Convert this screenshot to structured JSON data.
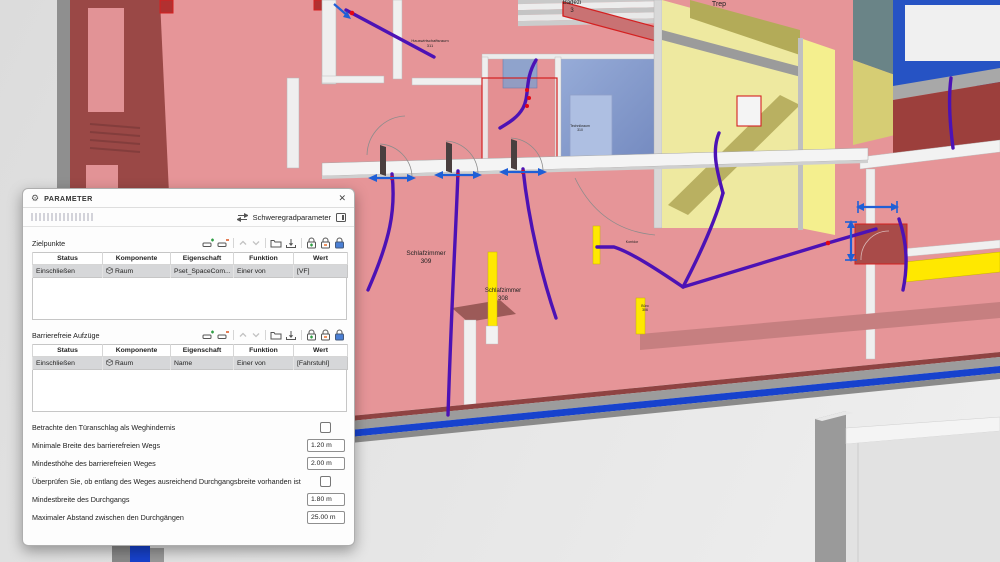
{
  "dialog": {
    "title": "PARAMETER",
    "mode_label": "Schweregradparameter",
    "close_glyph": "✕",
    "sections": [
      {
        "label": "Zielpunkte",
        "columns": [
          "Status",
          "Komponente",
          "Eigenschaft",
          "Funktion",
          "Wert"
        ],
        "rows": [
          {
            "status": "Einschließen",
            "komponente": "Raum",
            "eigenschaft": "Pset_SpaceCom...",
            "funktion": "Einer von",
            "wert": "[VF]"
          }
        ]
      },
      {
        "label": "Barrierefreie Aufzüge",
        "columns": [
          "Status",
          "Komponente",
          "Eigenschaft",
          "Funktion",
          "Wert"
        ],
        "rows": [
          {
            "status": "Einschließen",
            "komponente": "Raum",
            "eigenschaft": "Name",
            "funktion": "Einer von",
            "wert": "[Fahrstuhl]"
          }
        ]
      }
    ],
    "section_toolbar_icons": [
      "add-row",
      "remove-row",
      "move-up",
      "move-down",
      "open-folder",
      "import",
      "add-lock",
      "unlock",
      "lock"
    ],
    "options": [
      {
        "label": "Betrachte den Türanschlag als Weghindernis",
        "type": "checkbox",
        "checked": false
      },
      {
        "label": "Minimale Breite des barrierefreien Wegs",
        "type": "input",
        "value": "1.20 m"
      },
      {
        "label": "Mindesthöhe des barrierefreien Weges",
        "type": "input",
        "value": "2.00 m"
      },
      {
        "label": "Überprüfen Sie, ob entlang des Weges ausreichend Durchgangsbreite vorhanden ist",
        "type": "checkbox",
        "checked": false
      },
      {
        "label": "Mindestbreite des Durchgangs",
        "type": "input",
        "value": "1.80 m"
      },
      {
        "label": "Maximaler Abstand zwischen den Durchgängen",
        "type": "input",
        "value": "25.00 m"
      }
    ]
  },
  "scene": {
    "labels": {
      "hwr1": "Hauswirtschaftsraum",
      "hwr2": "311",
      "bad1": "Badezi",
      "bad2": "3",
      "trep": "Trep",
      "tech1": "Technikraum",
      "tech2": "310",
      "korridor": "Korridor",
      "buero1": "Büro",
      "buero2": "306",
      "sz309a": "Schlafzimmer",
      "sz309b": "309",
      "sz308a": "Schlafzimmer",
      "sz308b": "308"
    },
    "colors": {
      "route_purple": "#4c12b5",
      "dimension_blue": "#1f5fd6",
      "selection_red": "#d42020",
      "highlight_yellow": "#ffe800",
      "slab_edge_blue": "#1742cd",
      "floor_pink": "#e69598"
    }
  }
}
